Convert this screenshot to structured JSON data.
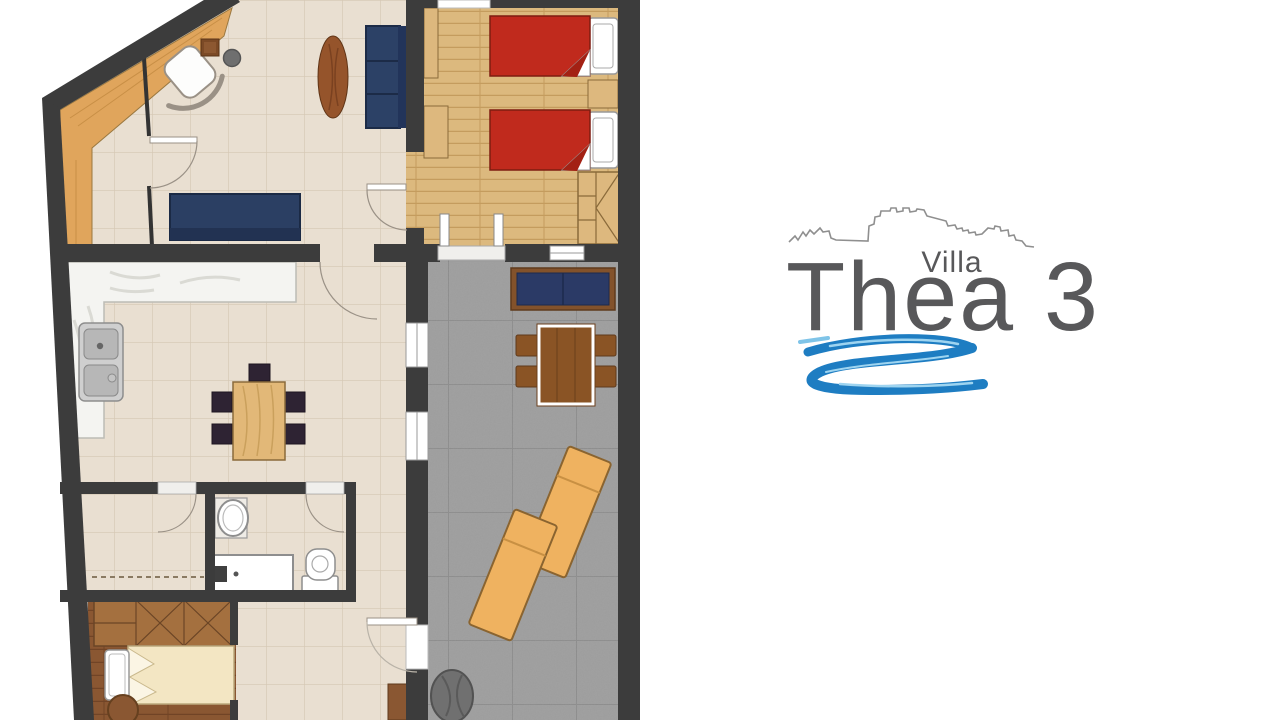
{
  "logo": {
    "villa_label": "Villa",
    "name": "Thea 3",
    "text_color": "#58585a",
    "skyline_color": "#8f8f8f",
    "swirl_color": "#1e7dc2",
    "swirl_highlight": "#9ed4f0"
  },
  "floorplan": {
    "colors": {
      "wall": "#3c3c3c",
      "tile_floor": "#e9dfd1",
      "tile_line": "#d5c7b4",
      "wood_light": "#dcb97e",
      "wood_light_line": "#c49c5e",
      "wood_dark": "#8a5732",
      "wood_dark_line": "#714426",
      "entry_wood": "#e0a55c",
      "marble": "#f4f4f1",
      "terrace_stone": "#9d9d9d",
      "terrace_line": "#8a8a8a",
      "navy_sofa": "#2c4166",
      "red_bed": "#c02a1d",
      "cream_bed": "#f3e6c3",
      "lounger": "#efb260",
      "terrace_furniture_brown": "#8a5425",
      "chair_dark": "#2e2333",
      "planter_gray": "#707070"
    },
    "rooms": [
      {
        "name": "living-room",
        "floor": "beige-tile"
      },
      {
        "name": "twin-bedroom",
        "floor": "light-wood"
      },
      {
        "name": "kitchen-dining",
        "floor": "beige-tile"
      },
      {
        "name": "terrace",
        "floor": "gray-stone"
      },
      {
        "name": "bathroom",
        "floor": "beige-tile"
      },
      {
        "name": "closet-room",
        "floor": "beige-tile"
      },
      {
        "name": "single-bedroom",
        "floor": "dark-wood"
      },
      {
        "name": "entry-hall",
        "floor": "beige-tile"
      }
    ],
    "furniture": [
      {
        "room": "living-room",
        "item": "armchair"
      },
      {
        "room": "living-room",
        "item": "side-table"
      },
      {
        "room": "living-room",
        "item": "stool"
      },
      {
        "room": "living-room",
        "item": "oval-coffee-table"
      },
      {
        "room": "living-room",
        "item": "navy-sofa"
      },
      {
        "room": "living-room",
        "item": "navy-bench"
      },
      {
        "room": "twin-bedroom",
        "item": "single-bed-red"
      },
      {
        "room": "twin-bedroom",
        "item": "single-bed-red"
      },
      {
        "room": "twin-bedroom",
        "item": "nightstand"
      },
      {
        "room": "twin-bedroom",
        "item": "wardrobe"
      },
      {
        "room": "kitchen-dining",
        "item": "counter-marble"
      },
      {
        "room": "kitchen-dining",
        "item": "double-sink"
      },
      {
        "room": "kitchen-dining",
        "item": "dining-table"
      },
      {
        "room": "kitchen-dining",
        "item": "chairs-x5"
      },
      {
        "room": "bathroom",
        "item": "washbasin"
      },
      {
        "room": "bathroom",
        "item": "bathtub"
      },
      {
        "room": "bathroom",
        "item": "toilet"
      },
      {
        "room": "single-bedroom",
        "item": "wardrobe"
      },
      {
        "room": "single-bedroom",
        "item": "single-bed-cream"
      },
      {
        "room": "terrace",
        "item": "outdoor-bench"
      },
      {
        "room": "terrace",
        "item": "outdoor-table"
      },
      {
        "room": "terrace",
        "item": "outdoor-chairs-x4"
      },
      {
        "room": "terrace",
        "item": "sun-lounger"
      },
      {
        "room": "terrace",
        "item": "sun-lounger"
      },
      {
        "room": "terrace",
        "item": "planter"
      }
    ]
  }
}
